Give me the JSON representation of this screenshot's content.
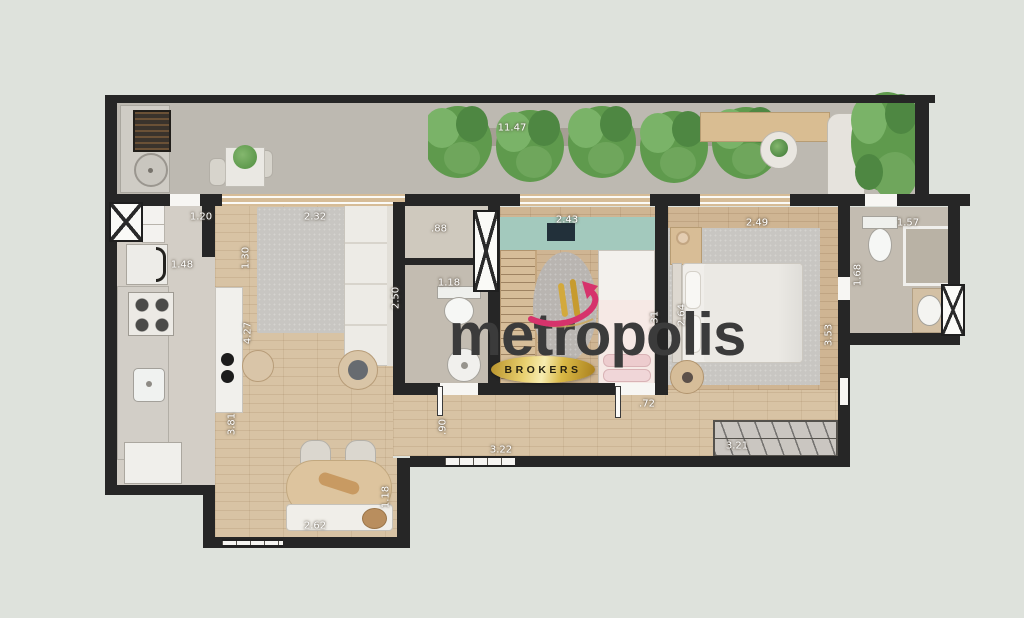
{
  "watermark": {
    "brand": "metropolis",
    "badge": "BROKERS"
  },
  "palette": {
    "background": "#dee2dc",
    "wall": "#262626",
    "wood_floor": "#d8c3a4",
    "bedroom_wood": "#cfb593",
    "bathroom_tile": "#c3bcb1",
    "balcony_floor": "#bdb9b1",
    "rug_gray": "#c8c5c0",
    "headboard_green": "#a3c9bd",
    "plant_green": "#5f9a4d",
    "furniture_wood": "#d9bd92",
    "brand_text": "#3b3b3b",
    "badge_gold": "#d4af37",
    "logo_pink": "#d6336c"
  },
  "dimensions": [
    {
      "text": "11.47",
      "x": 512,
      "y": 128,
      "orient": "h"
    },
    {
      "text": "1.20",
      "x": 201,
      "y": 217,
      "orient": "h"
    },
    {
      "text": "2.32",
      "x": 315,
      "y": 217,
      "orient": "h"
    },
    {
      "text": "1.48",
      "x": 182,
      "y": 265,
      "orient": "h"
    },
    {
      "text": "1.30",
      "x": 246,
      "y": 258,
      "orient": "v"
    },
    {
      "text": "4.27",
      "x": 248,
      "y": 333,
      "orient": "v"
    },
    {
      "text": "3.81",
      "x": 232,
      "y": 424,
      "orient": "v"
    },
    {
      "text": "2.62",
      "x": 315,
      "y": 526,
      "orient": "h"
    },
    {
      "text": "1.18",
      "x": 386,
      "y": 497,
      "orient": "v"
    },
    {
      "text": ".90",
      "x": 443,
      "y": 427,
      "orient": "v"
    },
    {
      "text": "3.22",
      "x": 501,
      "y": 450,
      "orient": "h"
    },
    {
      "text": ".88",
      "x": 439,
      "y": 229,
      "orient": "h"
    },
    {
      "text": "1.18",
      "x": 449,
      "y": 283,
      "orient": "h"
    },
    {
      "text": "2.50",
      "x": 396,
      "y": 298,
      "orient": "v"
    },
    {
      "text": "2.43",
      "x": 567,
      "y": 220,
      "orient": "h"
    },
    {
      "text": "2.31",
      "x": 655,
      "y": 322,
      "orient": "v"
    },
    {
      "text": "2.49",
      "x": 757,
      "y": 223,
      "orient": "h"
    },
    {
      "text": "2.64",
      "x": 682,
      "y": 315,
      "orient": "v"
    },
    {
      "text": "3.53",
      "x": 829,
      "y": 335,
      "orient": "v"
    },
    {
      "text": ".72",
      "x": 647,
      "y": 404,
      "orient": "h"
    },
    {
      "text": "3.21",
      "x": 737,
      "y": 446,
      "orient": "h"
    },
    {
      "text": "1.57",
      "x": 908,
      "y": 223,
      "orient": "h"
    },
    {
      "text": "1.68",
      "x": 858,
      "y": 275,
      "orient": "v"
    }
  ]
}
